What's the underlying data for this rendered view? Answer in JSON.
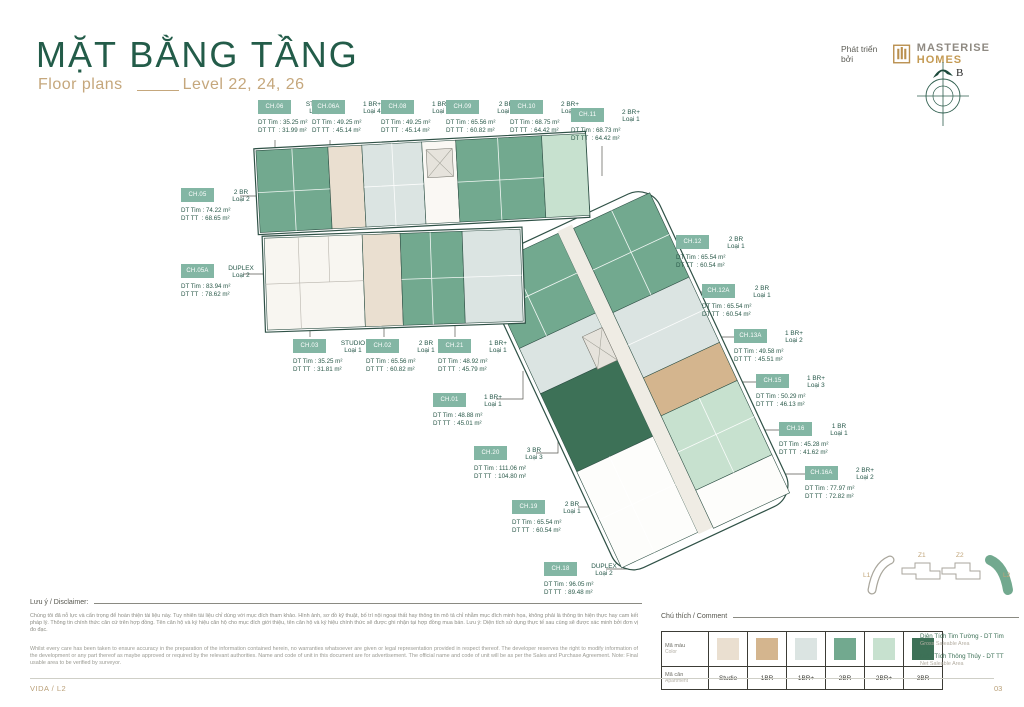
{
  "header": {
    "title": "MẶT BẰNG TẦNG",
    "subtitle_left": "Floor plans",
    "subtitle_right": "Level 22, 24, 26",
    "developer_prefix": "Phát triển bởi",
    "brand_name_1": "MASTERISE",
    "brand_name_2": "HOMES",
    "compass_label": "B"
  },
  "unit_label_prefixes": {
    "dt_tim": "DT Tim",
    "dt_tt": "DT TT",
    "unit_suffix": "m²"
  },
  "units": [
    {
      "code": "CH.06",
      "type": "STUDIO",
      "loai": "Loại 1",
      "dt_tim": "35.25",
      "dt_tt": "31.99"
    },
    {
      "code": "CH.06A",
      "type": "1 BR+",
      "loai": "Loại 4",
      "dt_tim": "49.25",
      "dt_tt": "45.14"
    },
    {
      "code": "CH.08",
      "type": "1 BR+",
      "loai": "Loại 4",
      "dt_tim": "49.25",
      "dt_tt": "45.14"
    },
    {
      "code": "CH.09",
      "type": "2 BR",
      "loai": "Loại 1",
      "dt_tim": "65.56",
      "dt_tt": "60.82"
    },
    {
      "code": "CH.10",
      "type": "2 BR+",
      "loai": "Loại 1",
      "dt_tim": "68.75",
      "dt_tt": "64.42"
    },
    {
      "code": "CH.11",
      "type": "2 BR+",
      "loai": "Loại 1",
      "dt_tim": "68.73",
      "dt_tt": "64.42"
    },
    {
      "code": "CH.05",
      "type": "2 BR",
      "loai": "Loại 2",
      "dt_tim": "74.22",
      "dt_tt": "68.65"
    },
    {
      "code": "CH.05A",
      "type": "DUPLEX",
      "loai": "Loại 2",
      "dt_tim": "83.94",
      "dt_tt": "78.62"
    },
    {
      "code": "CH.03",
      "type": "STUDIO",
      "loai": "Loại 1",
      "dt_tim": "35.25",
      "dt_tt": "31.81"
    },
    {
      "code": "CH.02",
      "type": "2 BR",
      "loai": "Loại 1",
      "dt_tim": "65.56",
      "dt_tt": "60.82"
    },
    {
      "code": "CH.21",
      "type": "1 BR+",
      "loai": "Loại 1",
      "dt_tim": "48.92",
      "dt_tt": "45.79"
    },
    {
      "code": "CH.01",
      "type": "1 BR+",
      "loai": "Loại 1",
      "dt_tim": "48.88",
      "dt_tt": "45.01"
    },
    {
      "code": "CH.20",
      "type": "3 BR",
      "loai": "Loại 3",
      "dt_tim": "111.06",
      "dt_tt": "104.80"
    },
    {
      "code": "CH.19",
      "type": "2 BR",
      "loai": "Loại 1",
      "dt_tim": "65.54",
      "dt_tt": "60.54"
    },
    {
      "code": "CH.18",
      "type": "DUPLEX",
      "loai": "Loại 2",
      "dt_tim": "96.05",
      "dt_tt": "89.48"
    },
    {
      "code": "CH.12",
      "type": "2 BR",
      "loai": "Loại 1",
      "dt_tim": "65.54",
      "dt_tt": "60.54"
    },
    {
      "code": "CH.12A",
      "type": "2 BR",
      "loai": "Loại 1",
      "dt_tim": "65.54",
      "dt_tt": "60.54"
    },
    {
      "code": "CH.13A",
      "type": "1 BR+",
      "loai": "Loại 2",
      "dt_tim": "49.58",
      "dt_tt": "45.51"
    },
    {
      "code": "CH.15",
      "type": "1 BR+",
      "loai": "Loại 3",
      "dt_tim": "50.29",
      "dt_tt": "46.13"
    },
    {
      "code": "CH.16",
      "type": "1 BR",
      "loai": "Loại 1",
      "dt_tim": "45.28",
      "dt_tt": "41.62"
    },
    {
      "code": "CH.16A",
      "type": "2 BR+",
      "loai": "Loại 2",
      "dt_tim": "77.97",
      "dt_tt": "72.82"
    }
  ],
  "disclaimer": {
    "heading": "Lưu ý / Disclaimer:",
    "vi": "Chúng tôi đã nỗ lực và cẩn trọng để hoàn thiện tài liệu này. Tuy nhiên tài liệu chỉ dùng với mục đích tham khảo. Hình ảnh, sơ đồ kỹ thuật, bố trí nội ngoại thất hay thông tin mô tả chỉ nhằm mục đích minh họa, không phải là thông tin hiện thực hay cam kết pháp lý. Thông tin chính thức căn cứ trên hợp đồng. Tên căn hộ và ký hiệu căn hộ cho mục đích giới thiệu, tên căn hộ và ký hiệu chính thức sẽ được ghi nhận tại hợp đồng mua bán. Lưu ý: Diện tích sử dụng thực tế sau cùng sẽ được xác minh bởi đơn vị đo đạc.",
    "en": "Whilst every care has been taken to ensure accuracy in the preparation of the information contained herein, no warranties whatsoever are given or legal representation provided in respect thereof. The developer reserves the right to modify information of the development or any part thereof as maybe approved or required by the relevant authorities. Name and code of unit in this document are for advertisement. The official name and code of unit will be as per the Sales and Purchase Agreement. Note: Final usable area to be verified by surveyor."
  },
  "legend": {
    "heading": "Chú thích / Comment",
    "row1_label_vi": "Mã màu",
    "row1_label_en": "Color",
    "row2_label_vi": "Mã căn",
    "row2_label_en": "Apartment",
    "items": [
      {
        "label": "Studio",
        "color": "#eadfd0"
      },
      {
        "label": "1BR",
        "color": "#d4b58e"
      },
      {
        "label": "1BR+",
        "color": "#dbe4e2"
      },
      {
        "label": "2BR",
        "color": "#72a98f"
      },
      {
        "label": "2BR+",
        "color": "#c7e1cf"
      },
      {
        "label": "3BR",
        "color": "#3d7157"
      }
    ],
    "area_terms": [
      {
        "vi": "Diện Tích Tim Tường - DT Tim",
        "en": "Gross Saleable Area"
      },
      {
        "vi": "Diện Tích Thông Thủy - DT TT",
        "en": "Net Saleable Area"
      }
    ],
    "zones": [
      "L1",
      "Z1",
      "Z2",
      "L2"
    ]
  },
  "footer": {
    "left": "VIDA / L2",
    "right": "03"
  },
  "colors": {
    "brand_green": "#235c49",
    "accent_tan": "#c5a77c",
    "callout_teal": "#83b6a4",
    "logo_gold": "#c49a53"
  }
}
